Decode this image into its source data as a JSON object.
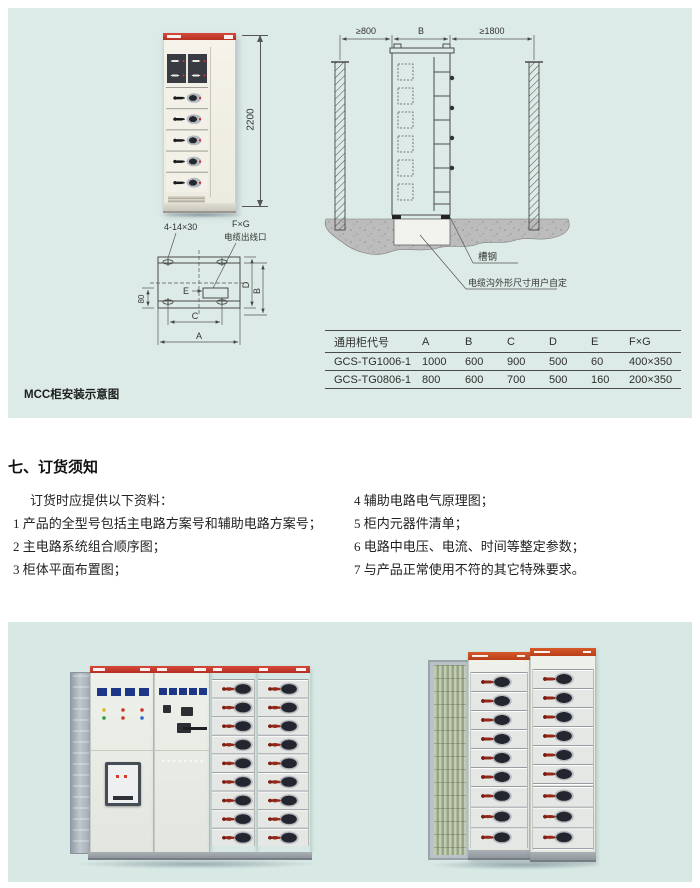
{
  "installation": {
    "caption": "MCC柜安装示意图",
    "front_view": {
      "height_dim": "2200"
    },
    "plan_view": {
      "holes_label": "4-14×30",
      "outlet_size_label": "F×G",
      "outlet_label": "电缆出线口",
      "dim_a": "A",
      "dim_b": "B",
      "dim_c": "C",
      "dim_d": "D",
      "dim_e": "E",
      "dim_80": "80"
    },
    "section_view": {
      "left_clearance": "≥800",
      "cabinet_width": "B",
      "right_clearance": "≥1800",
      "channel_steel_label": "槽钢",
      "trench_label": "电缆沟外形尺寸用户自定"
    },
    "table": {
      "headers": [
        "通用柜代号",
        "A",
        "B",
        "C",
        "D",
        "E",
        "F×G"
      ],
      "rows": [
        [
          "GCS-TG1006-1",
          "1000",
          "600",
          "900",
          "500",
          "60",
          "400×350"
        ],
        [
          "GCS-TG0806-1",
          "800",
          "600",
          "700",
          "500",
          "160",
          "200×350"
        ]
      ]
    }
  },
  "ordering": {
    "heading": "七、订货须知",
    "intro": "订货时应提供以下资料：",
    "left_items": [
      "1 产品的全型号包括主电路方案号和辅助电路方案号；",
      "2 主电路系统组合顺序图；",
      "3 柜体平面布置图；"
    ],
    "right_items": [
      "4 辅助电路电气原理图；",
      "5 柜内元器件清单；",
      "6 电路中电压、电流、时间等整定参数；",
      "7 与产品正常使用不符的其它特殊要求。"
    ]
  },
  "colors": {
    "panel_bg": "#dcebe7",
    "accent_red": "#c43a2b",
    "accent_orange": "#c44a20"
  }
}
